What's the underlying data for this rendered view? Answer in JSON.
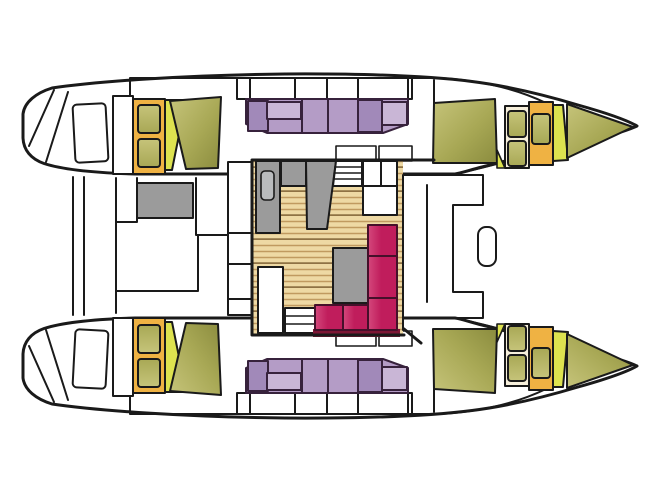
{
  "meta": {
    "title": "Catamaran yacht interior layout plan (top-down deck view)",
    "diagram_type": "boat-floorplan",
    "orientation": "bow pointing right, stern at left, two symmetric hulls joined by center saloon",
    "visible_text": ""
  },
  "colors": {
    "outline": "#1a1a1a",
    "white": "#ffffff",
    "wood": "#eed9a4",
    "wood_line": "#c09a60",
    "wood_line_dark": "#8f7244",
    "purple": "#b49cc6",
    "purple_dark": "#a189b9",
    "purple_light": "#c9b6d6",
    "purple_outline": "#37223c",
    "olive_light": "#c6c47a",
    "olive": "#a8a855",
    "olive_dark": "#8b8c3e",
    "yellow_green": "#dde24f",
    "gold": "#efb243",
    "cream": "#f6efdb",
    "red": "#c01d5c",
    "red_light": "#d4487c",
    "red_dark": "#7d1634",
    "settee_outline": "#45102a",
    "gray": "#9b9b9b",
    "gray_light": "#b9bbbd"
  },
  "regions": [
    {
      "id": "port-hull",
      "label": "Port hull (top)"
    },
    {
      "id": "starboard-hull",
      "label": "Starboard hull (bottom, mirrored)"
    },
    {
      "id": "stern-platform",
      "label": "Transom swim steps"
    },
    {
      "id": "aft-cabinet",
      "label": "Aft gold cabinet with two hatches"
    },
    {
      "id": "aft-berth-cushion",
      "label": "Aft cabin olive berth cushion"
    },
    {
      "id": "mid-berth",
      "label": "Purple double berth with pillows"
    },
    {
      "id": "bow-berth-cushion",
      "label": "Forepeak olive cushions"
    },
    {
      "id": "bow-cabinet",
      "label": "Bow lockers (cream and gold with hatches)"
    },
    {
      "id": "cockpit",
      "label": "Aft cockpit with gray table"
    },
    {
      "id": "saloon",
      "label": "Center saloon with wood floor"
    },
    {
      "id": "galley",
      "label": "Gray galley counters and sink"
    },
    {
      "id": "settee",
      "label": "Red L-shaped settee"
    },
    {
      "id": "saloon-table",
      "label": "Gray saloon table"
    },
    {
      "id": "companionway-steps",
      "label": "Steps down into hulls"
    },
    {
      "id": "foredeck-front",
      "label": "Forward bulkhead and foredeck seat"
    }
  ]
}
